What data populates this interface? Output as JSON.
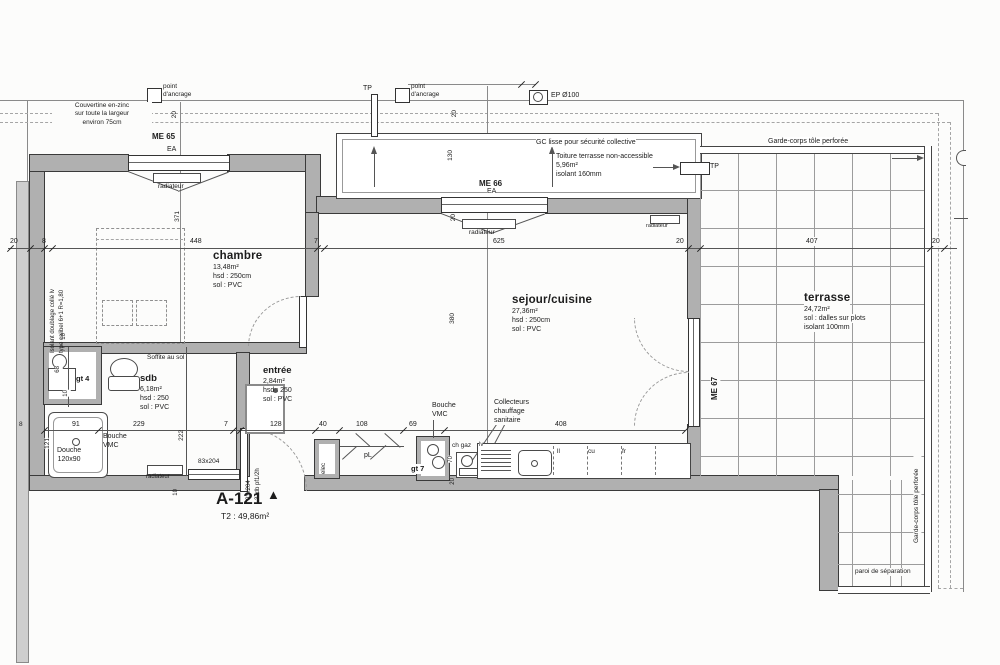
{
  "apartment": {
    "code": "A-121",
    "marker": "▲",
    "type": "T2 : 49,86m²"
  },
  "rooms": {
    "chambre": {
      "name": "chambre",
      "area": "13,48m²",
      "height": "hsd : 250cm",
      "floor": "sol : PVC"
    },
    "sejour": {
      "name": "sejour/cuisine",
      "area": "27,36m²",
      "height": "hsd : 250cm",
      "floor": "sol : PVC"
    },
    "sdb": {
      "name": "sdb",
      "area": "6,18m²",
      "height": "hsd : 250",
      "floor": "sol : PVC"
    },
    "entree": {
      "name": "entrée",
      "area": "2,84m²",
      "height": "hsd : 250",
      "floor": "sol : PVC"
    },
    "terrasse": {
      "name": "terrasse",
      "area": "24,72m²",
      "floor": "sol : dalles sur plots",
      "insulation": "isolant 100mm"
    },
    "toiture": {
      "text": "Toiture terrasse non-accessible\n5,96m²\nisolant 160mm"
    }
  },
  "openings": {
    "me65": "ME 65",
    "me66": "ME 66",
    "me67": "ME 67",
    "ea": "EA",
    "door_sdb": "83x204",
    "door_entry": "93x204",
    "door_entry_fire": "37db pf1/2h"
  },
  "labels": {
    "couvertine": "Couvertine en-zinc\nsur toute la largeur\nenviron 75cm",
    "anchor": "point\nd'ancrage",
    "tp": "TP",
    "ep": "EP Ø100",
    "gc_lisse": "GC lisse pour sécurité collective",
    "garde_corps": "Garde-corps tôle perforée",
    "paroi": "paroi de séparation",
    "soffite": "Soffite au sol",
    "isolant1": "Isolant doublage collé lv",
    "isolant2": "type calibel 6+1 R=1,80",
    "radiateur": "radiateur",
    "bouche_vmc": "Bouche\nVMC",
    "collecteurs": "Collecteurs\nchauffage\nsanitaire",
    "ch_gaz": "ch gaz",
    "douche": "Douche\n120x90",
    "gt4": "gt 4",
    "gt7": "gt 7",
    "elec": "elec",
    "pl": "pL",
    "lv": "lv",
    "ll": "ll",
    "cu": "cu",
    "fr": "fr"
  },
  "dims": {
    "top": [
      "20",
      "8",
      "448",
      "7",
      "625",
      "20",
      "407",
      "20"
    ],
    "mid": [
      "91",
      "229",
      "7",
      "128",
      "40",
      "108",
      "69",
      "408"
    ],
    "v": {
      "d371": "371",
      "d380": "380",
      "d222": "222",
      "d130": "130",
      "d121": "121",
      "d68": "68",
      "d70": "70",
      "d10": "10",
      "d8": "8",
      "d20": "20"
    }
  }
}
